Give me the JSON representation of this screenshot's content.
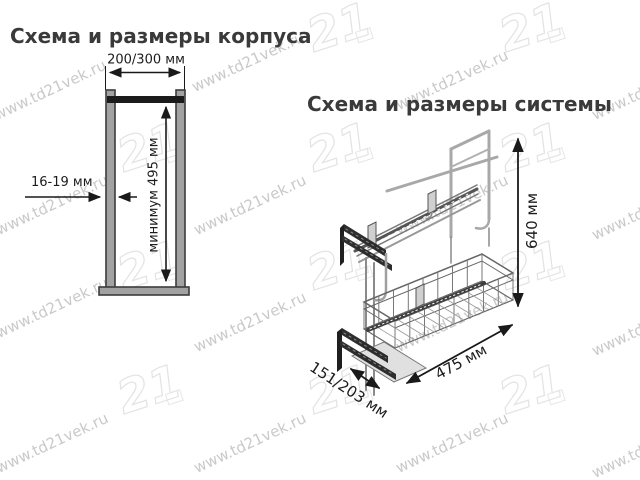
{
  "watermark": {
    "text": "www.td21vek.ru",
    "logo_text": "21",
    "text_color": "#c9c9c9",
    "logo_color": "#e3e3e3"
  },
  "corpus_section": {
    "title": "Схема и размеры корпуса",
    "dimensions": {
      "width": "200/300 мм",
      "panel_thickness": "16-19 мм",
      "inner_height": "минимум 495 мм"
    },
    "colors": {
      "panel_fill": "#a2a2a2",
      "panel_stroke": "#3c3c3c",
      "rail_fill": "#1b1b1b",
      "dimension_line": "#1a1a1a"
    }
  },
  "system_section": {
    "title": "Схема и размеры системы",
    "dimensions": {
      "height": "640 мм",
      "depth": "475 мм",
      "width": "151/203 мм"
    }
  }
}
